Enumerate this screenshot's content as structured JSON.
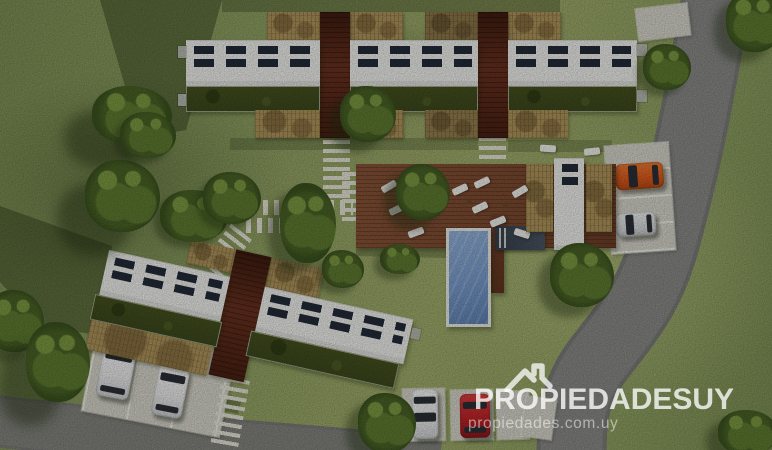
{
  "watermark": {
    "brand_text": "PROPIEDADESUY",
    "website_text": "propiedades.com.uy",
    "icon": "house-roof-icon"
  },
  "palette": {
    "grass": "#90a263",
    "grass_light": "#a2ae6c",
    "grass_dark": "#7e9055",
    "shadow": "rgba(34,47,18,0.42)",
    "road": "#8b8b89",
    "road_edge": "#7c7c7a",
    "concrete": "#d9d7cc",
    "stall_line": "#f3f2ea",
    "roof_white": "#f2f3ef",
    "solar_panel": "#232c3a",
    "green_roof": "#3d491d",
    "pergola": "#b1975e",
    "deck": "#7e4c32",
    "courtyard": "#54281a",
    "pool_water": "#7b9ecf",
    "pool_rim": "#eef0ea",
    "stone_path": "#eae8da",
    "tree_dark": "#4a6326",
    "tree_mid": "#5f7c31",
    "tree_light": "#7d9a42",
    "car_orange": "#e05a1d",
    "car_red": "#c02427",
    "car_white": "#ededee",
    "car_silver": "#d8dadb",
    "watermark_text": "rgba(255,255,255,0.78)",
    "watermark_sub": "rgba(255,255,255,0.50)"
  },
  "scene": {
    "description": "Aerial 3D render of a housing development: two rows of flat-roof row houses with solar panels and green roofs, wooden courtyard decks, central amenity deck with sun loungers, swimming pool, stepping-stone paths, parking bays and curved access roads.",
    "building_rows": 2,
    "row_house_units": 5,
    "swimming_pools": 1,
    "cars": {
      "total": 6,
      "white": 3,
      "silver": 1,
      "orange": 1,
      "red": 1
    }
  }
}
